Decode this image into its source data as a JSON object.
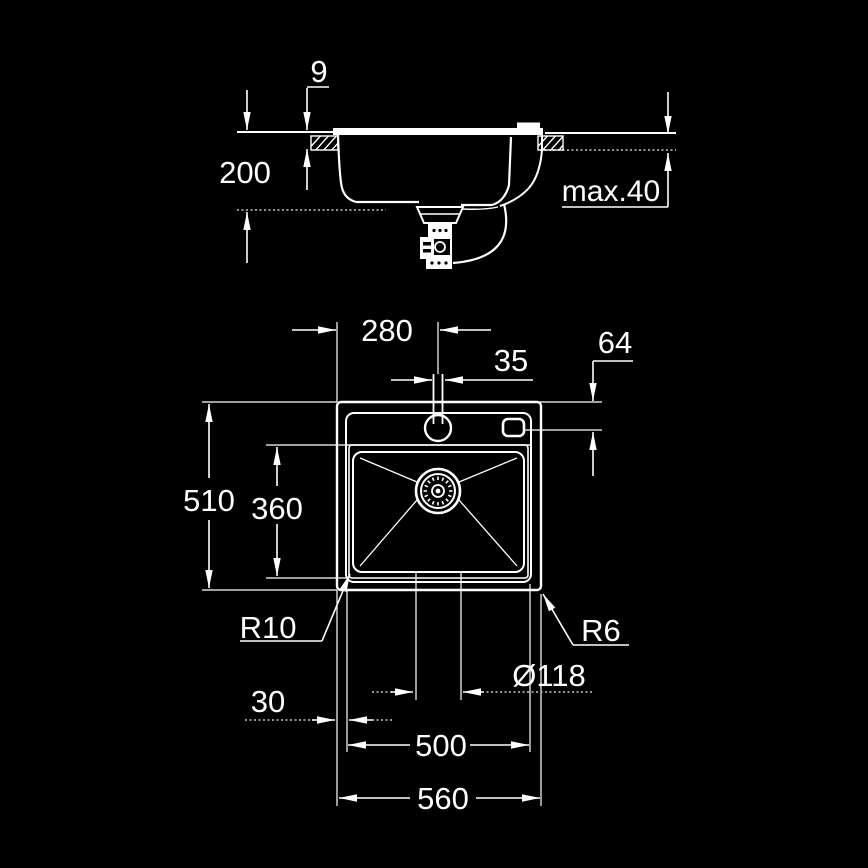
{
  "title": "Sink installation technical drawing",
  "colors": {
    "background": "#000000",
    "line": "#ffffff",
    "dashed_line": "#c8c8c8"
  },
  "side_view": {
    "labels": {
      "rim_height": "9",
      "bowl_depth": "200",
      "max_counter_thickness": "max.40"
    }
  },
  "top_view": {
    "labels": {
      "tap_center_from_left": "280",
      "tap_hole": "35",
      "accessory_hole_offset": "64",
      "overall_depth": "510",
      "bowl_depth": "360",
      "bowl_corner_radius": "R10",
      "outer_corner_radius": "R6",
      "drain_diameter": "Ø118",
      "edge_gap": "30",
      "bowl_width": "500",
      "overall_width": "560"
    }
  }
}
